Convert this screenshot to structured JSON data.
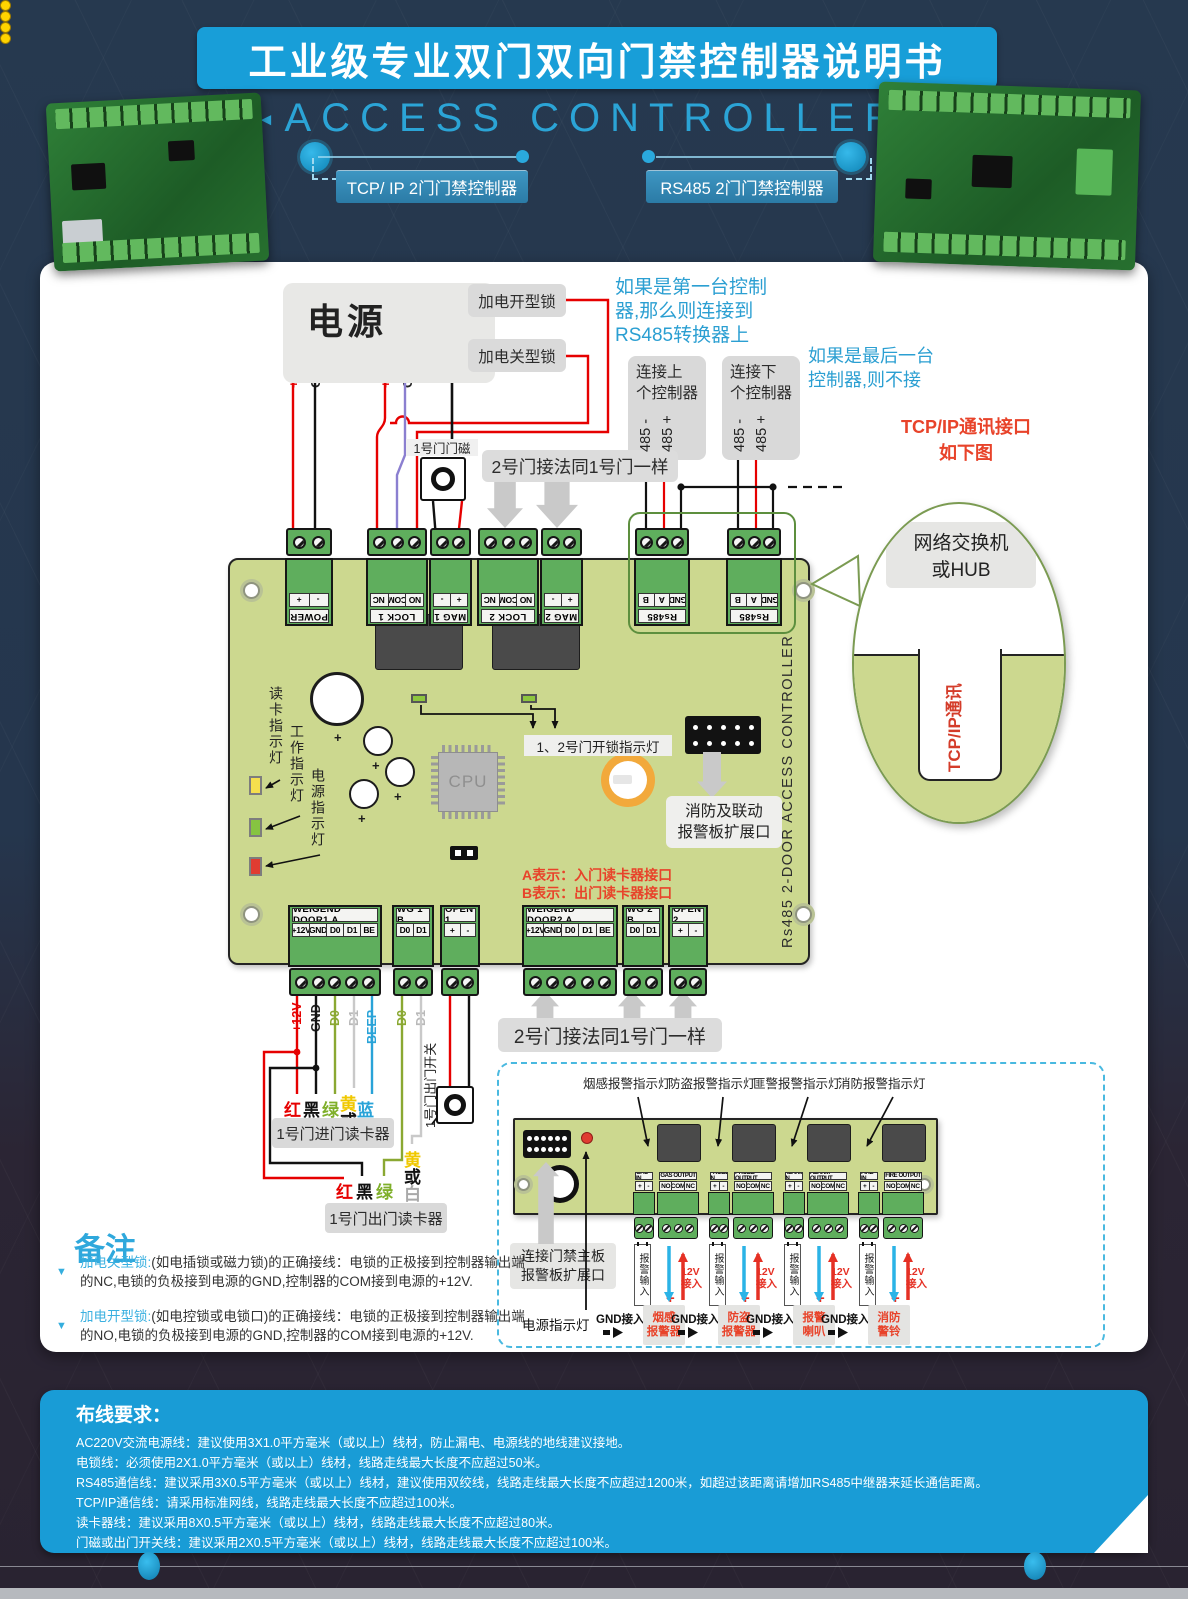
{
  "page": {
    "title": "工业级专业双门双向门禁控制器说明书",
    "subtitle": "ACCESS CONTROLLER",
    "tags": [
      "TCP/ IP 2门门禁控制器",
      "RS485 2门门禁控制器"
    ]
  },
  "annotations": {
    "first_controller": [
      "如果是第一台控制",
      "器,那么则连接到",
      "RS485转换器上"
    ],
    "last_controller": [
      "如果是最后一台",
      "控制器,则不接"
    ],
    "tcpip_note": [
      "TCP/IP通讯接口",
      "如下图"
    ],
    "hub_label": [
      "网络交换机",
      "或HUB"
    ],
    "tcpip_port": "TCP/IP通讯",
    "door2_same_top": "2号门接法同1号门一样",
    "door2_same_bottom": "2号门接法同1号门一样",
    "door1_magnet": "1号门门磁",
    "reader_ab": [
      "A表示：入门读卡器接口",
      "B表示：出门读卡器接口"
    ]
  },
  "power": {
    "label": "电源",
    "pins": [
      "+12V",
      "GND",
      "+12V",
      "GND"
    ]
  },
  "locks": {
    "no_type": "加电开型锁",
    "nc_type": "加电关型锁"
  },
  "link_boxes": {
    "up": [
      "连接上",
      "个控制器"
    ],
    "down": [
      "连接下",
      "个控制器"
    ],
    "pins": [
      "485 -",
      "485 +"
    ]
  },
  "board": {
    "side_label": "Rs485 2-DOOR ACCESS CONTROLLER",
    "cpu": "CPU",
    "led_labels": [
      "读卡指示灯",
      "工作指示灯",
      "电源指示灯"
    ],
    "unlock_label": "1、2号门开锁指示灯",
    "fire_port": [
      "消防及联动",
      "报警板扩展口"
    ],
    "top_groups": [
      {
        "name": "POWER",
        "pins": [
          "+",
          "-"
        ]
      },
      {
        "name": "LOCK 1",
        "pins": [
          "NC",
          "COM",
          "NO"
        ]
      },
      {
        "name": "MAG 1",
        "pins": [
          "-",
          "+"
        ]
      },
      {
        "name": "LOCK 2",
        "pins": [
          "NC",
          "COM",
          "NO"
        ]
      },
      {
        "name": "MAG 2",
        "pins": [
          "-",
          "+"
        ]
      },
      {
        "name": "Rs485",
        "pins": [
          "B",
          "A",
          "GND"
        ]
      },
      {
        "name": "Rs485",
        "pins": [
          "B",
          "A",
          "GND"
        ]
      }
    ],
    "bottom_groups": [
      {
        "name": "WEIGEND DOOR1 A",
        "pins": [
          "+12V",
          "GND",
          "D0",
          "D1",
          "BE"
        ]
      },
      {
        "name": "WG 1 B",
        "pins": [
          "D0",
          "D1"
        ]
      },
      {
        "name": "OPEN 1",
        "pins": [
          "+",
          "-"
        ]
      },
      {
        "name": "WEIGEND DOOR2 A",
        "pins": [
          "+12V",
          "GND",
          "D0",
          "D1",
          "BE"
        ]
      },
      {
        "name": "WG 2 B",
        "pins": [
          "D0",
          "D1"
        ]
      },
      {
        "name": "OPEN 2",
        "pins": [
          "+",
          "-"
        ]
      }
    ]
  },
  "wiring": {
    "door1_labels": [
      "+12V",
      "GND",
      "D0",
      "D1",
      "BEEP"
    ],
    "wg1b_labels": [
      "D0",
      "D1"
    ],
    "exit_switch": "1号门出门开关",
    "reader1_colors": [
      "红",
      "黑",
      "绿",
      "黄",
      "或",
      "白",
      "蓝"
    ],
    "reader2_colors": [
      "红",
      "黑",
      "绿",
      "黄",
      "或",
      "白"
    ],
    "reader1": "1号门进门读卡器",
    "reader2": "1号门出门读卡器"
  },
  "alarm": {
    "indicators": [
      "烟感报警指示灯",
      "防盗报警指示灯",
      "匪警报警指示灯",
      "消防报警指示灯"
    ],
    "groups": [
      {
        "in_name": "GAS IN",
        "out_name": "GAS OUTPUT"
      },
      {
        "in_name": "PROBE IN",
        "out_name": "PROBE OUTPUT"
      },
      {
        "in_name": "ALARM IN",
        "out_name": "ALARM OUTPUT"
      },
      {
        "in_name": "FIRE IN",
        "out_name": "FIRE OUTPUT"
      }
    ],
    "in_pins": [
      "+",
      "-"
    ],
    "out_pins": [
      "NO",
      "COM",
      "NC"
    ],
    "input_label": "报警输入",
    "v12_line1": "12V",
    "v12_line2": "接入",
    "plus": "+",
    "gnd": "GND接入",
    "devices": [
      [
        "烟感",
        "报警器"
      ],
      [
        "防盗",
        "报警器"
      ],
      [
        "报警",
        "喇叭"
      ],
      [
        "消防",
        "警铃"
      ]
    ],
    "connect": [
      "连接门禁主板",
      "报警板扩展口"
    ],
    "power_led": "电源指示灯"
  },
  "notes": {
    "title": "备注",
    "items": [
      {
        "term": "加电关型锁:",
        "body": "(如电插锁或磁力锁)的正确接线：电锁的正极接到控制器输出端的NC,电锁的负极接到电源的GND,控制器的COM接到电源的+12V."
      },
      {
        "term": "加电开型锁:",
        "body": "(如电控锁或电锁口)的正确接线：电锁的正极接到控制器输出端的NO,电锁的负极接到电源的GND,控制器的COM接到电源的+12V."
      }
    ]
  },
  "wiring_req": {
    "title": "布线要求：",
    "lines": [
      "AC220V交流电源线：建议使用3X1.0平方毫米（或以上）线材，防止漏电、电源线的地线建议接地。",
      "电锁线：必须使用2X1.0平方毫米（或以上）线材，线路走线最大长度不应超过50米。",
      "RS485通信线：建议采用3X0.5平方毫米（或以上）线材，建议使用双绞线，线路走线最大长度不应超过1200米，如超过该距离请增加RS485中继器来延长通信距离。",
      "TCP/IP通信线：请采用标准网线，线路走线最大长度不应超过100米。",
      "读卡器线：建议采用8X0.5平方毫米（或以上）线材，线路走线最大长度不应超过80米。",
      "门磁或出门开关线：建议采用2X0.5平方毫米（或以上）线材，线路走线最大长度不应超过100米。"
    ]
  },
  "colors": {
    "accent": "#199CD6",
    "pcb": "#CCD88F",
    "terminal": "#5FAE5D",
    "red_note": "#E8432A",
    "blue_note": "#2B9FD2",
    "wire_red": "#E60000",
    "wire_purple": "#8B7FD0",
    "wire_blue": "#2BB3E6",
    "led_yellow": "#F5DF4E",
    "led_green": "#86C441",
    "led_red": "#E03C31"
  }
}
